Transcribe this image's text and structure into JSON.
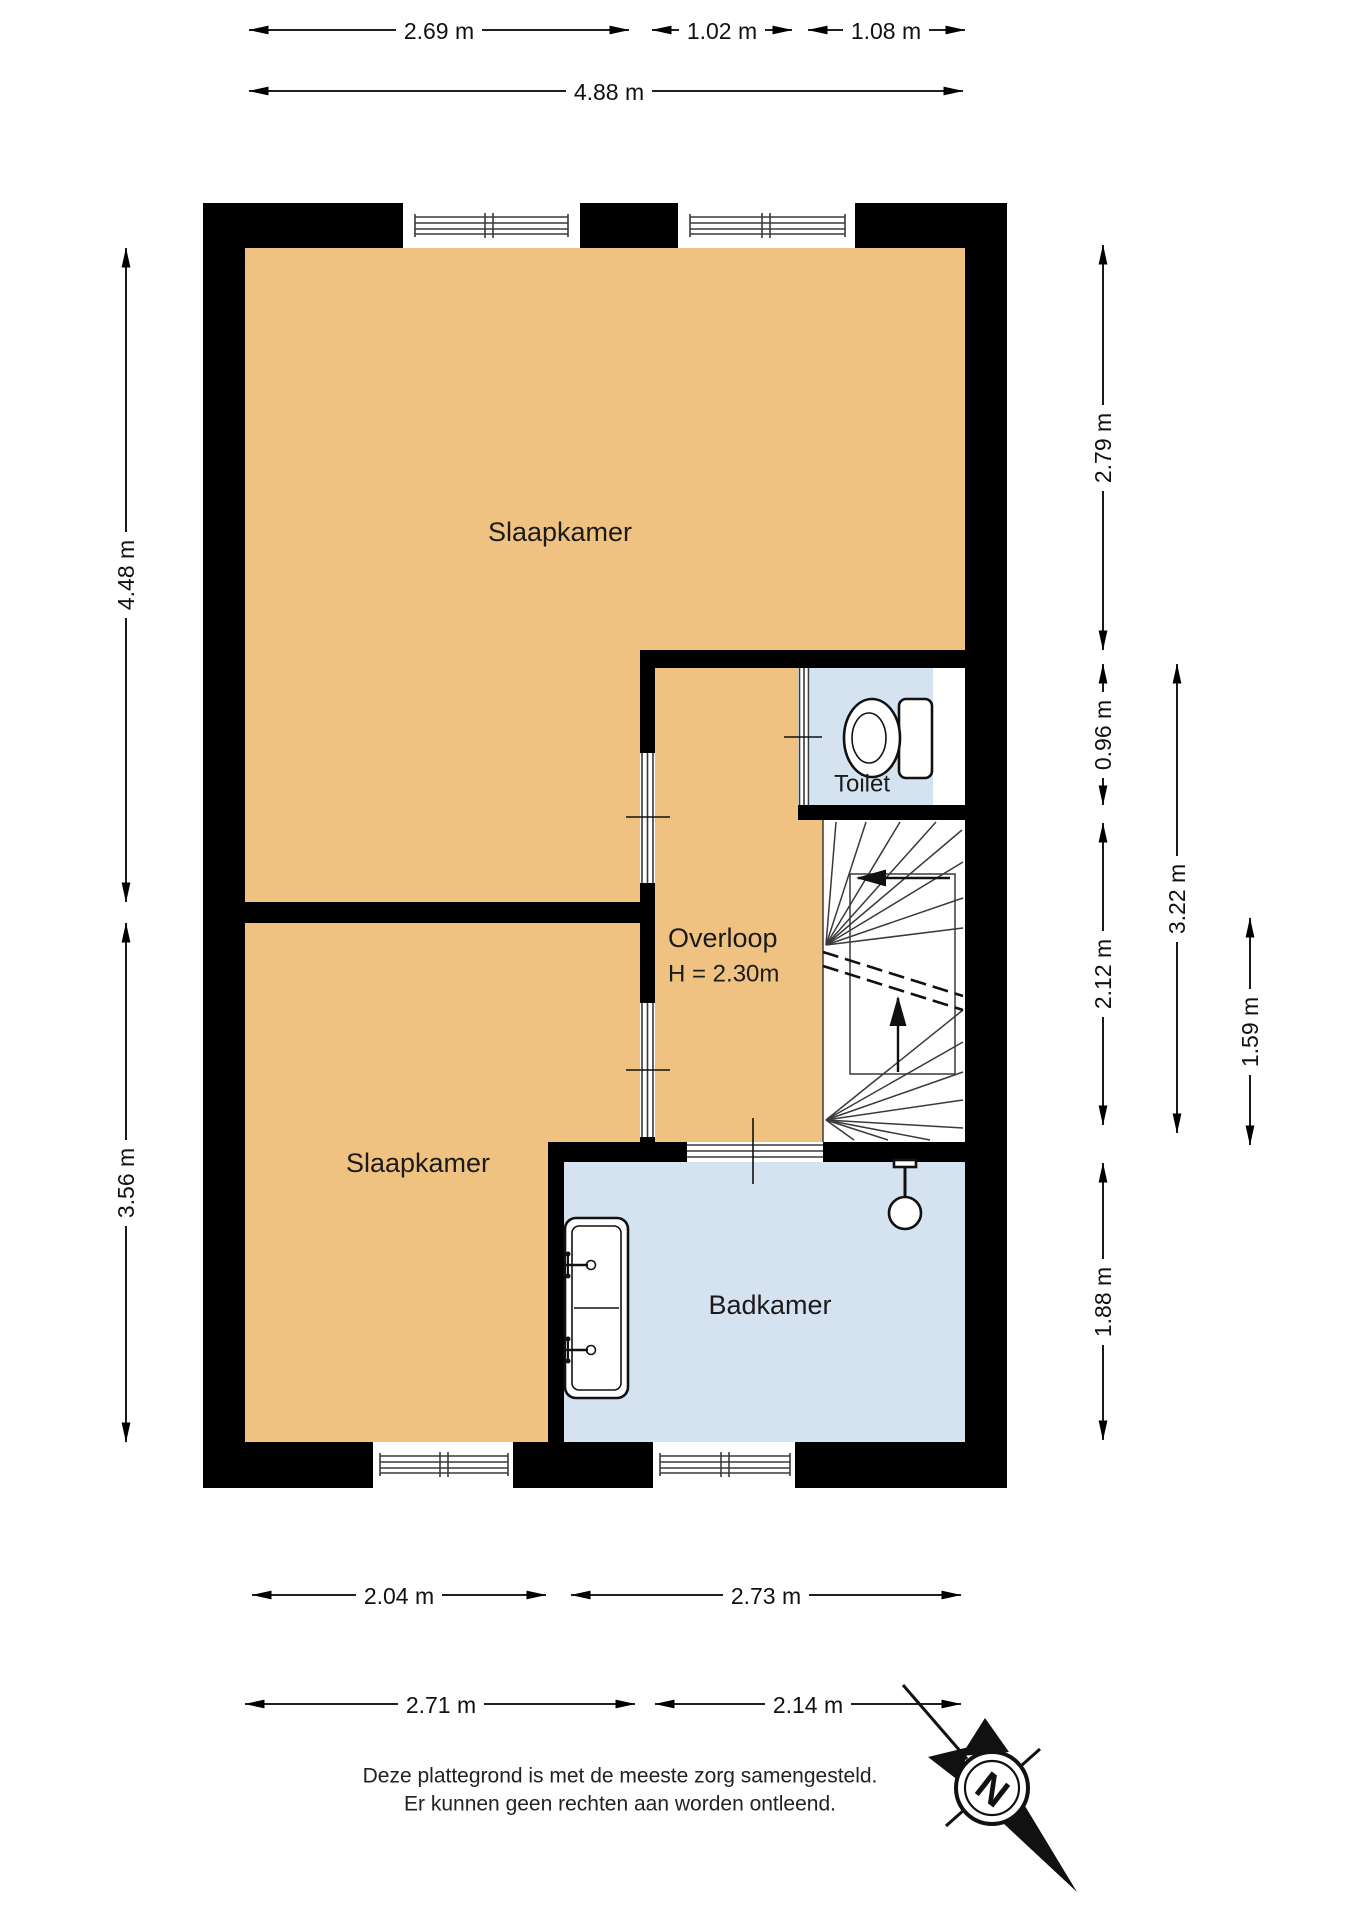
{
  "title": "Plattegrond verdieping",
  "rooms": {
    "bedroom_top": {
      "label": "Slaapkamer"
    },
    "bedroom_bottom": {
      "label": "Slaapkamer"
    },
    "landing": {
      "label": "Overloop",
      "height_note": "H = 2.30m"
    },
    "toilet": {
      "label": "Toilet"
    },
    "bathroom": {
      "label": "Badkamer"
    }
  },
  "dimensions": {
    "top": [
      {
        "label": "2.69 m"
      },
      {
        "label": "1.02 m"
      },
      {
        "label": "1.08 m"
      }
    ],
    "top_total": {
      "label": "4.88 m"
    },
    "left": [
      {
        "label": "4.48 m"
      },
      {
        "label": "3.56 m"
      }
    ],
    "right_col1": [
      {
        "label": "2.79 m"
      },
      {
        "label": "0.96 m"
      },
      {
        "label": "2.12 m"
      },
      {
        "label": "1.88 m"
      }
    ],
    "right_col2": {
      "label": "3.22 m"
    },
    "right_col3": {
      "label": "1.59 m"
    },
    "bottom_row1": [
      {
        "label": "2.04 m"
      },
      {
        "label": "2.73 m"
      }
    ],
    "bottom_row2": [
      {
        "label": "2.71 m"
      },
      {
        "label": "2.14 m"
      }
    ]
  },
  "compass": {
    "label": "N"
  },
  "disclaimer": {
    "line1": "Deze plattegrond is met de meeste zorg samengesteld.",
    "line2": "Er kunnen geen rechten aan worden ontleend."
  },
  "colors": {
    "wall": "#000000",
    "room_orange": "#F0C282",
    "room_blue": "#D5E2EF"
  }
}
